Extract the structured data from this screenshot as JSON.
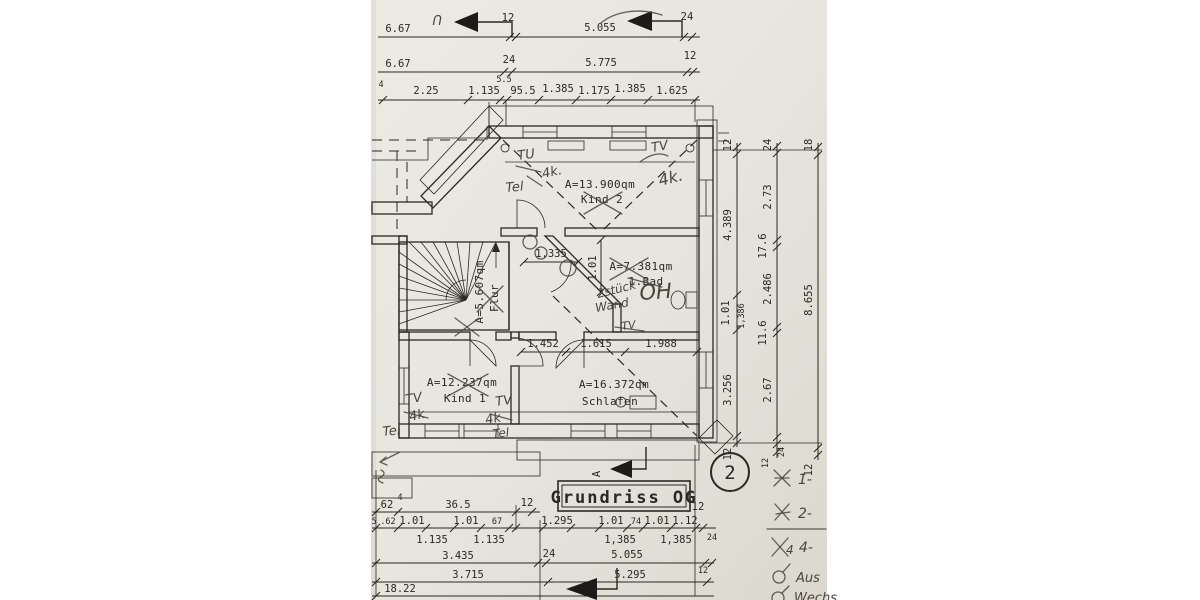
{
  "colors": {
    "paper": "#e8e6df",
    "paper_dark": "#dcd9d0",
    "ink": "#2b2823",
    "pencil": "#4a453c",
    "white": "#ffffff"
  },
  "top_dims": {
    "row1": {
      "d1": "6.67",
      "t1": "12",
      "d2": "5.055",
      "t2": "24"
    },
    "row2": {
      "d1": "6.67",
      "t1": "24",
      "d2": "5.775",
      "t2": "12"
    },
    "row3": {
      "s1": "4",
      "d1": "2.25",
      "d2": "1.135",
      "s2": "5.5",
      "d3": "95.5",
      "d4": "1.385",
      "d5": "1.175",
      "d6": "1.385",
      "d7": "1.625"
    },
    "bracket": "U"
  },
  "right_dims": {
    "col1": {
      "t1": "12",
      "d1": "4.389",
      "d2": "1.01",
      "d3": "1,386",
      "d4": "3.256",
      "t2": "12"
    },
    "col2": {
      "t1": "24",
      "d1": "2.73",
      "s1": "17.6",
      "d2": "2.486",
      "s2": "11.6",
      "d3": "2.67",
      "t2": "12",
      "t3": "24"
    },
    "col3": {
      "t1": "18",
      "d1": "8.655",
      "t2": "12"
    }
  },
  "bottom_dims": {
    "rowA": {
      "d1": "62",
      "s1": "4",
      "d2": "36.5",
      "t1": "12",
      "t2": "12"
    },
    "rowB": {
      "d0": "5",
      "d1": ".62",
      "d2": "1.01",
      "d3": "1.135",
      "d4": "1.01",
      "d5": "1.135",
      "d6": "67",
      "d7": "1.295",
      "d8": "1.01",
      "d9": "1,385",
      "d10": "74",
      "d11": "1.01",
      "d12": "1,385",
      "d13": "1.12",
      "t1": "24"
    },
    "rowC": {
      "d1": "3.435",
      "t1": "24",
      "d2": "5.055"
    },
    "rowD": {
      "d1": "3.715",
      "d2": "5.295",
      "t1": "12"
    },
    "rowE": {
      "d1": "18.22"
    }
  },
  "inner_dims": {
    "d1": "1.335",
    "d2": "1.01",
    "d3": "1.452",
    "d4": "1.615",
    "d5": "1.988"
  },
  "rooms": {
    "kind2": {
      "area": "A=13.900qm",
      "name": "Kind 2"
    },
    "flur": {
      "area": "A=5.607qm",
      "name": "Flur"
    },
    "bad": {
      "area": "A=7.381qm",
      "name": "1.Bad"
    },
    "kind1": {
      "area": "A=12.237qm",
      "name": "Kind 1"
    },
    "schlafen": {
      "area": "A=16.372qm",
      "name": "Schlafen"
    }
  },
  "title_block": {
    "title": "Grundriss OG",
    "sheet_no": "2",
    "section_letter": "A"
  },
  "annotations": {
    "kind2_left_1": "TU",
    "kind2_left_2": "4k.",
    "kind2_left_3": "Tel",
    "kind2_right_1": "TV",
    "kind2_right_2": "4k.",
    "bad_1": "2stück",
    "bad_2": "Wand",
    "bad_3": "OH",
    "bad_4": "TV",
    "kind1_left_1": "TV",
    "kind1_left_2": "4k",
    "kind1_left_3": "Tel",
    "kind1_right_1": "TV",
    "kind1_right_2": "4k",
    "kind1_right_3": "Tel",
    "legend": {
      "i1": "1-",
      "i2": "2-",
      "i3_sym": "4",
      "i3": "4-",
      "i4": "Aus",
      "i5": "Wechs"
    }
  }
}
